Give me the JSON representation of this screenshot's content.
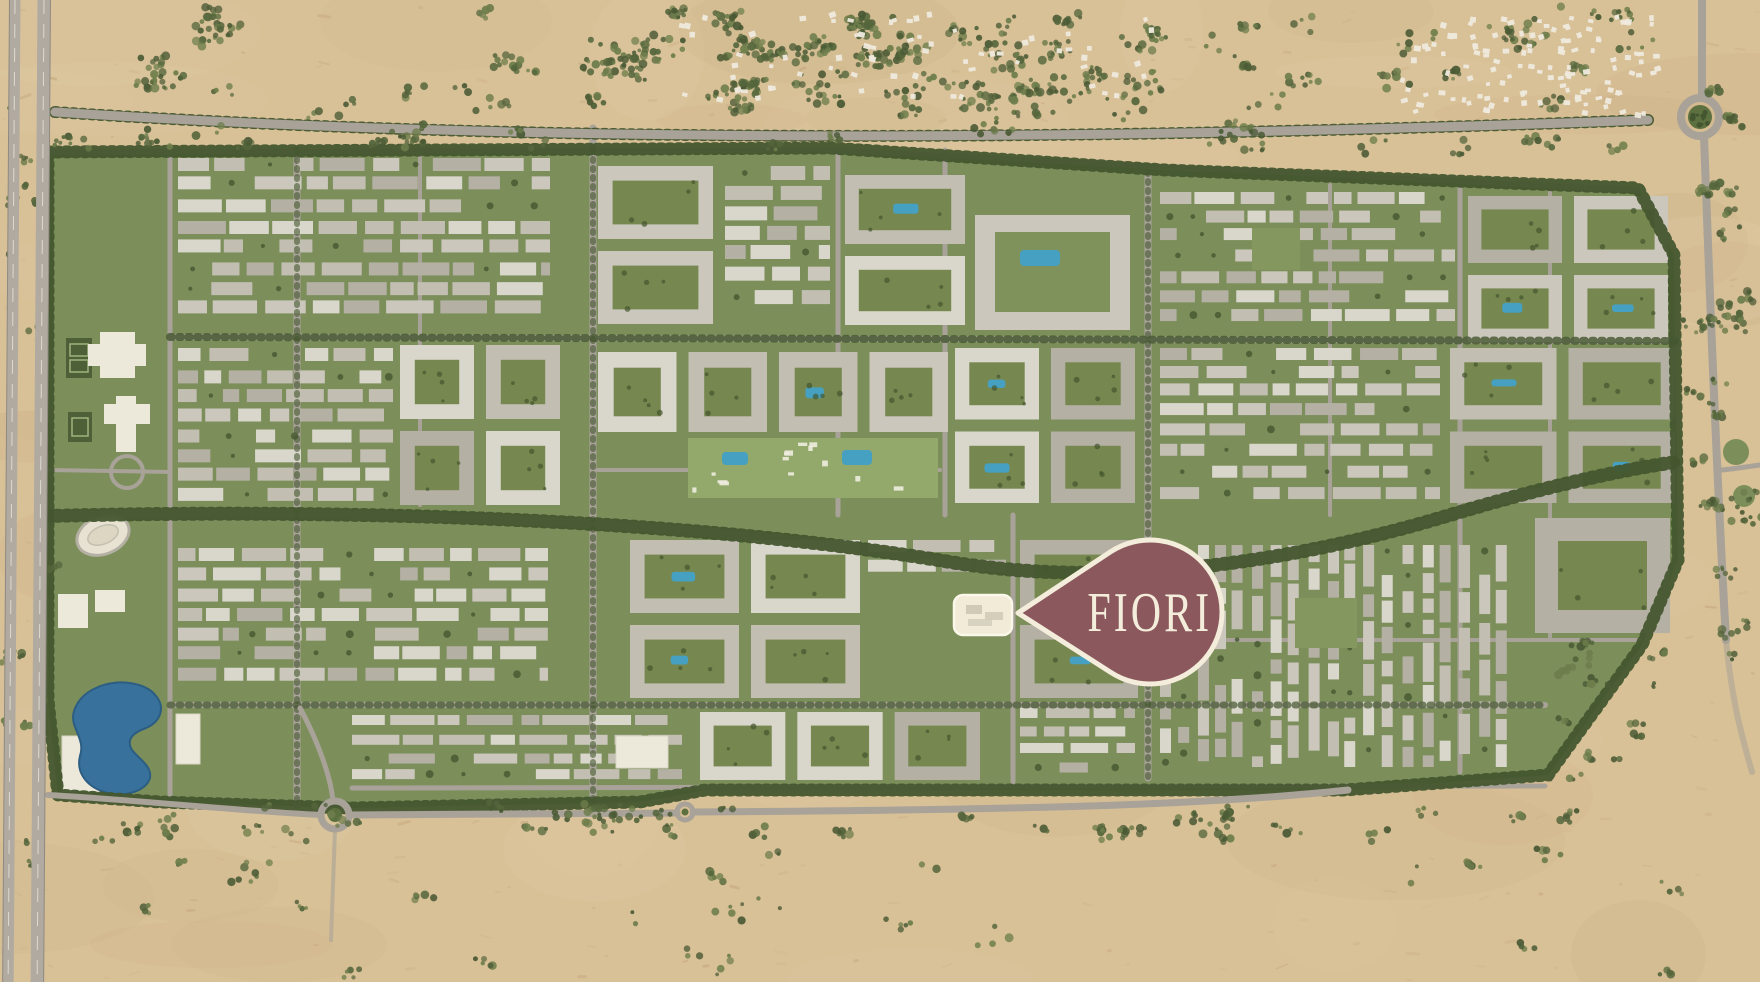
{
  "page": {
    "title": "FIORI masterplan location map"
  },
  "marker": {
    "label": "FIORI"
  },
  "colors": {
    "marker_fill": "#8b595d",
    "marker_outline": "#f4eddb",
    "marker_text": "#f4eddb",
    "highlight_building": "#f1ebd8",
    "sand": "#d8c097",
    "sand_light": "#e6d3ad",
    "sand_dark": "#c7ac82",
    "scrub": "#55663c",
    "road": "#a8a298",
    "road_line": "#eae6dc",
    "development_green": "#7c8f5b",
    "lawn": "#93a96b",
    "courtyard": "#76884f",
    "tree": "#44562f",
    "building": "#cbc7bc",
    "building_light": "#d9d6cc",
    "building_shadow": "#b4b0a4",
    "white_building": "#ece8da",
    "water": "#38719b",
    "pool": "#45a0c2"
  },
  "features": [
    {
      "name": "desert",
      "kind": "terrain"
    },
    {
      "name": "left-highway",
      "kind": "road"
    },
    {
      "name": "north-boundary-road",
      "kind": "road"
    },
    {
      "name": "south-boundary-road",
      "kind": "road"
    },
    {
      "name": "north-east-roundabout",
      "kind": "road"
    },
    {
      "name": "south-west-roundabout",
      "kind": "road"
    },
    {
      "name": "south-mini-roundabout",
      "kind": "road"
    },
    {
      "name": "desert-settlement-north",
      "kind": "structures"
    },
    {
      "name": "desert-settlement-north-east",
      "kind": "structures"
    },
    {
      "name": "residential-development",
      "kind": "district"
    },
    {
      "name": "central-avenue",
      "kind": "road"
    },
    {
      "name": "amenity-gardens",
      "kind": "park"
    },
    {
      "name": "lake",
      "kind": "water"
    },
    {
      "name": "stadium",
      "kind": "sports"
    },
    {
      "name": "tennis-courts",
      "kind": "sports"
    },
    {
      "name": "school-campus",
      "kind": "buildings"
    },
    {
      "name": "fiori-building",
      "kind": "highlight"
    }
  ]
}
